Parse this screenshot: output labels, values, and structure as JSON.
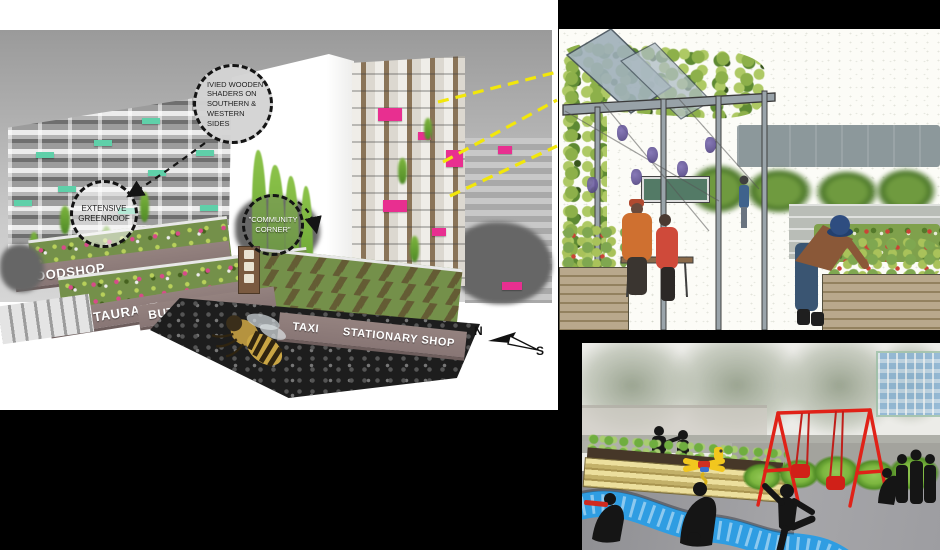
{
  "masterplan": {
    "annotations": {
      "shaders": "IVIED WOODEN SHADERS ON SOUTHERN & WESTERN SIDES",
      "greenroof": "EXTENSIVE GREENROOF",
      "community": "\"COMMUNITY CORNER\""
    },
    "shops": {
      "foodshop": "FOODSHOP",
      "restaurant": "RESTAURANT",
      "butchers": "BUTCHER'S",
      "taxi": "TAXI",
      "stationary": "STATIONARY SHOP"
    },
    "compass": {
      "north": "N",
      "south": "S"
    },
    "colors": {
      "balcony_teal": "#5fd0a9",
      "balcony_magenta": "#e82f90",
      "callout_yellow": "#f2e70a",
      "fascia_mauve": "#8d7b7b"
    }
  },
  "sketch": {
    "colors": {
      "vine_green": "#8db04a",
      "grape_purple": "#5d4f90",
      "timber_gray": "#98a2a8"
    }
  },
  "playground": {
    "colors": {
      "swing_red": "#e02218",
      "stream_blue": "#2f9de2",
      "planter_wood": "#ecdf9d",
      "silhouette": "#151515"
    }
  }
}
